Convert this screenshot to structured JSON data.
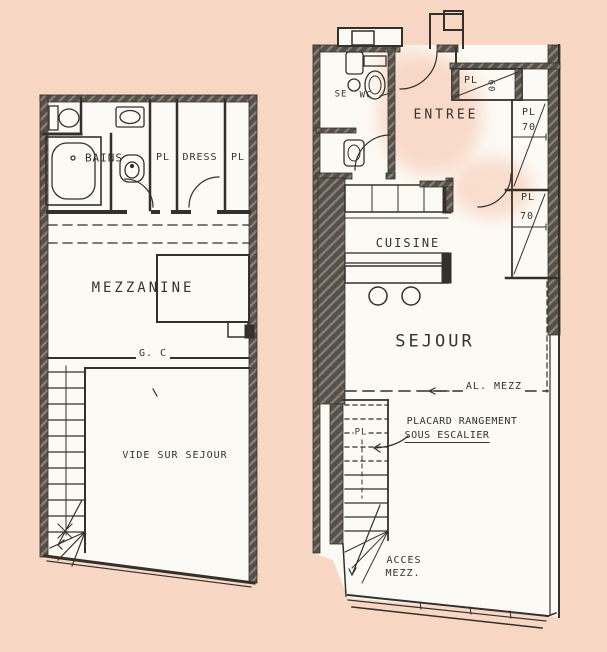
{
  "colors": {
    "background": "#f8d7c5",
    "paper": "#fcfaf4",
    "ink": "#34302a",
    "wall": "#55504a"
  },
  "left_plan": {
    "name": "niveau mezzanine",
    "labels": {
      "bains": "BAINS",
      "pl_1": "PL",
      "dress": "DRESS",
      "pl_2": "PL",
      "mezzanine": "MEZZANINE",
      "garde_corps": "G. C",
      "vide": "VIDE SUR SEJOUR"
    }
  },
  "right_plan": {
    "name": "niveau entree / sejour",
    "labels": {
      "se": "SE",
      "wc": "WC",
      "entree": "ENTREE",
      "pl_entree": "PL",
      "pl_entree_dim": "60",
      "pl_right_1": "PL",
      "pl_right_1_dim": "70",
      "pl_right_2": "PL",
      "pl_right_2_dim": "70",
      "cuisine": "CUISINE",
      "sejour": "SEJOUR",
      "al_mezz": "AL. MEZZ",
      "pl_stairs": "PL",
      "placard_1": "PLACARD RANGEMENT",
      "placard_2": "SOUS ESCALIER",
      "acces_1": "ACCES",
      "acces_2": "MEZZ."
    }
  }
}
